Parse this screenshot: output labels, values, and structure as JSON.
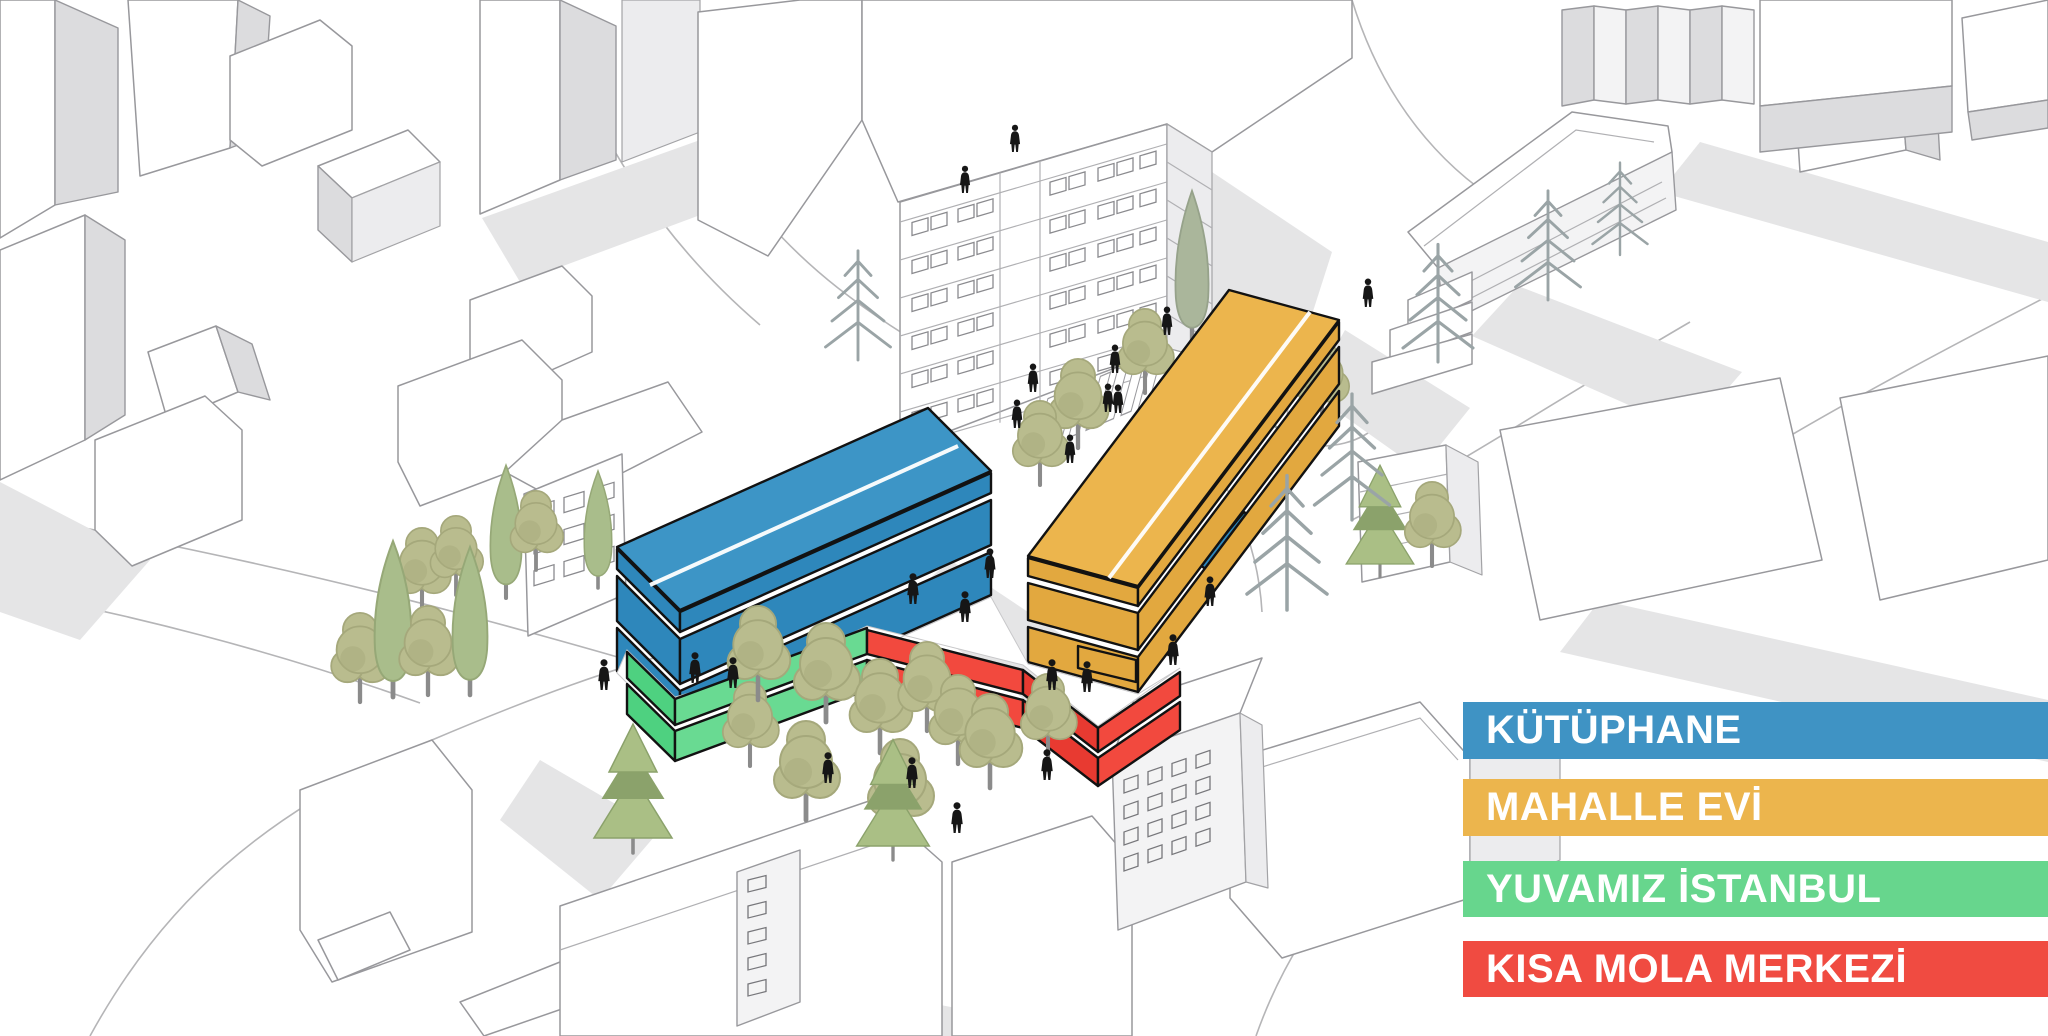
{
  "scene": {
    "kind": "axonometric-site-diagram",
    "icons": [
      "deciduous-tree-icon",
      "cypress-tree-icon",
      "pine-tree-icon",
      "sketch-pine-icon",
      "pedestrian-icon",
      "crosswalk-icon"
    ]
  },
  "legend": {
    "items": [
      {
        "id": "kutuphane",
        "label": "KÜTÜPHANE",
        "color": "#3F93C4"
      },
      {
        "id": "mahalle-evi",
        "label": "MAHALLE EVİ",
        "color": "#ECB54D"
      },
      {
        "id": "yuvamiz-istanbul",
        "label": "YUVAMIZ İSTANBUL",
        "color": "#67D68D"
      },
      {
        "id": "kisa-mola-merkezi",
        "label": "KISA MOLA MERKEZİ",
        "color": "#F04B41"
      }
    ]
  },
  "buildings": [
    {
      "name": "KÜTÜPHANE",
      "color": "#3D95C6",
      "form": "long two-storey bar, north-west of plaza"
    },
    {
      "name": "MAHALLE EVİ",
      "color": "#ECB54D",
      "form": "long two-storey bar, north-east of plaza"
    },
    {
      "name": "YUVAMIZ İSTANBUL",
      "color": "#67D68D",
      "form": "low podium wing, south-west edge of deck"
    },
    {
      "name": "KISA MOLA MERKEZİ",
      "color": "#F04B41",
      "form": "low podium wing, south-east edge of deck"
    }
  ],
  "palette": {
    "background": "#FFFFFF",
    "block_outline": "#98989C",
    "block_side": "#DCDCDE",
    "shadow": "#E5E5E6",
    "tree_olive": "#B9BC8E",
    "tree_pine": "#AABF85",
    "tree_sketch_pine": "#9AA4A6",
    "person": "#161616"
  }
}
